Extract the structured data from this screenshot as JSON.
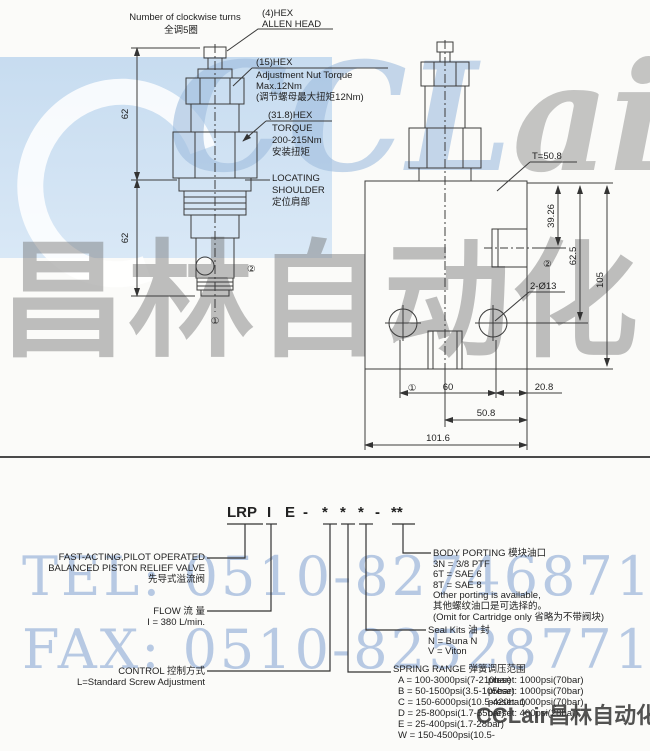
{
  "watermarks": {
    "brand_left": "CCL",
    "brand_right": "air",
    "chinese_large": "昌林自动化",
    "tel": "TEL: 0510-82746871",
    "fax": "FAX: 0510-82528771",
    "footer_brand": "CCLair昌林自动化"
  },
  "left_drawing": {
    "turns_en": "Number of clockwise turns",
    "turns_zh": "全调5圈",
    "allen1": "(4)HEX",
    "allen2": "ALLEN HEAD",
    "nut1": "(15)HEX",
    "nut2": "Adjustment Nut Torque",
    "nut3": "Max.12Nm",
    "nut4": "(调节螺母最大扭矩12Nm)",
    "hex1": "(31.8)HEX",
    "hex2": "TORQUE",
    "hex3": "200-215Nm",
    "hex4": "安装扭矩",
    "loc1": "LOCATING",
    "loc2": "SHOULDER",
    "loc3": "定位肩部",
    "dim_upper": "62",
    "dim_lower": "62",
    "port1": "①",
    "port2": "②"
  },
  "right_drawing": {
    "t_label": "T=50.8",
    "dim_3926": "39.26",
    "dim_625": "62.5",
    "dim_105": "105",
    "holes": "2-Ø13",
    "port1": "①",
    "port2": "②",
    "dim_60": "60",
    "dim_208": "20.8",
    "dim_508": "50.8",
    "dim_1016": "101.6"
  },
  "model_code": {
    "parts": [
      "LRP",
      "I",
      "E",
      "-",
      "*",
      "*",
      "*",
      "-",
      "**"
    ]
  },
  "descriptions": {
    "valve_type_line1": "FAST-ACTING,PILOT OPERATED",
    "valve_type_line2": "BALANCED PISTON RELIEF VALVE",
    "valve_type_line3": "先导式溢流阀",
    "flow_title": "FLOW 流 量",
    "flow_value": "I = 380 L/min.",
    "control_title": "CONTROL 控制方式",
    "control_value": "L=Standard Screw Adjustment",
    "body_porting": {
      "title": "BODY PORTING 模块油口",
      "opt1": "3N = 3/8 PTF",
      "opt2": "6T = SAE 6",
      "opt3": "8T = SAE 8",
      "note1": "Other porting is available,",
      "note2": "其他螺纹油口是可选择的。",
      "note3": "(Omit for Cartridge only 省略为不带阀块)"
    },
    "seal_kits": {
      "title": "Seal Kits 油  封",
      "opt1": "N = Buna N",
      "opt2": "V = Viton"
    },
    "spring_range": {
      "title": "SPRING RANGE  弹簧调压范围",
      "rows": [
        {
          "range": "A = 100-3000psi(7-210bar)",
          "preset": "preset: 1000psi(70bar)"
        },
        {
          "range": "B = 50-1500psi(3.5-105bar)",
          "preset": "preset: 1000psi(70bar)"
        },
        {
          "range": "C = 150-6000psi(10.5-420bar)",
          "preset": "preset: 1000psi(70bar)"
        },
        {
          "range": "D = 25-800psi(1.7-55bar)",
          "preset": "preset: 400psi(28bar)"
        },
        {
          "range": "E = 25-400psi(1.7-28bar)",
          "preset": ""
        },
        {
          "range": "W = 150-4500psi(10.5-",
          "preset": ""
        }
      ]
    }
  }
}
